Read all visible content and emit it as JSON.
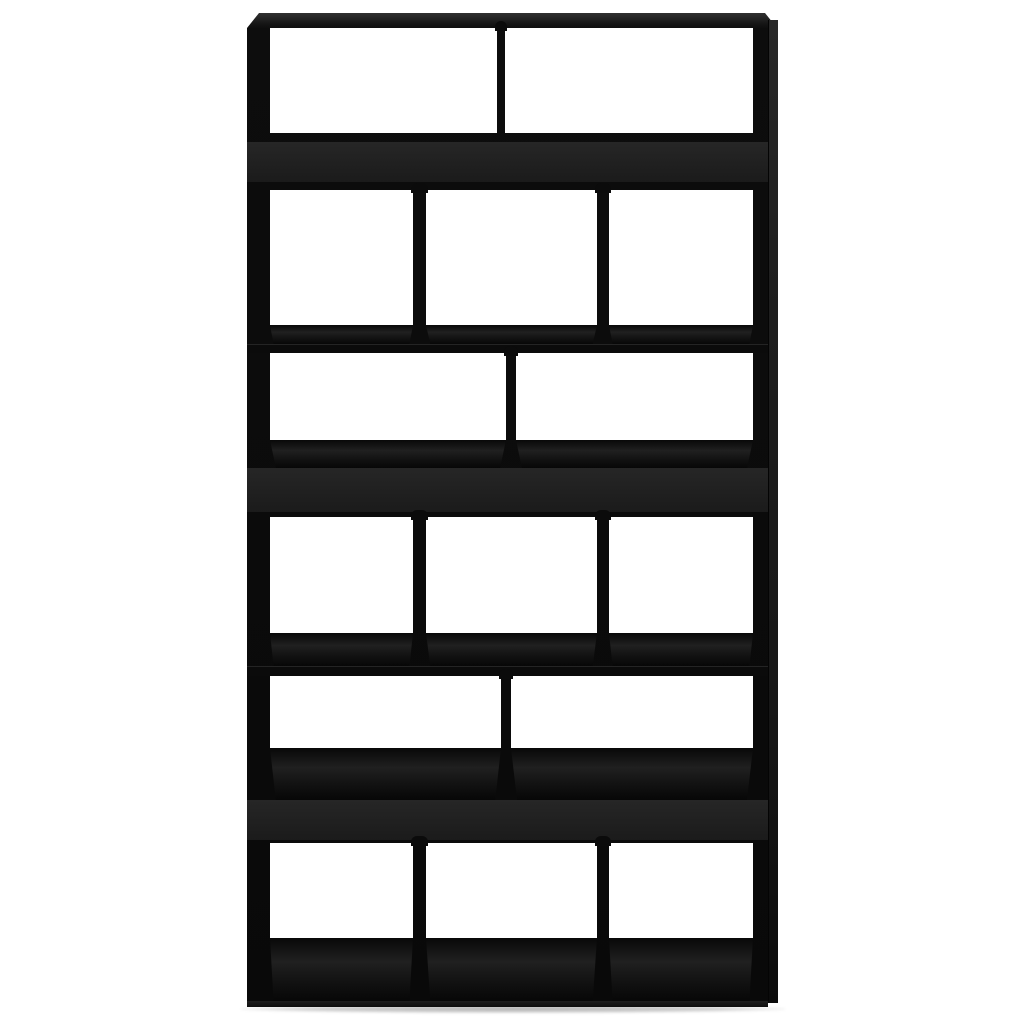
{
  "image": {
    "type": "product-photo",
    "subject": "Black wooden bookcase room divider with open compartments on a white background",
    "background_color": "#ffffff"
  },
  "colors": {
    "background": "#ffffff",
    "frame": "#0b0b0b",
    "frame_deep": "#060606",
    "band": "#262626",
    "band_dark": "#1b1b1b",
    "interior_floor": "#202020",
    "side_face": "#1e1e1e",
    "opening": "#ffffff",
    "shadow": "#c9c9c9"
  },
  "summary": {
    "open_rows": 6,
    "compartments_per_row": [
      2,
      3,
      2,
      3,
      2,
      3
    ],
    "total_compartments": 15,
    "closed_front_panels": 3
  },
  "unit": {
    "left": 247,
    "top": 13,
    "right": 777,
    "bottom": 1007,
    "front_right": 768,
    "inner_left": 270,
    "inner_right": 753,
    "top_board_bottom": 28
  },
  "rows": [
    {
      "name": "open-row-1",
      "kind": "open",
      "top": 28,
      "bottom": 133,
      "dividers": [
        [
          497,
          505
        ]
      ],
      "tabs": true
    },
    {
      "name": "front-panel-1",
      "kind": "band",
      "top": 133,
      "bottom": 190,
      "inner_top": 142,
      "inner_bottom": 182
    },
    {
      "name": "open-row-2",
      "kind": "open",
      "top": 190,
      "bottom": 325,
      "dividers": [
        [
          413,
          426
        ],
        [
          597,
          609
        ]
      ],
      "tabs": true
    },
    {
      "name": "shelf-ledge-1",
      "kind": "interior",
      "top": 325,
      "bottom": 353,
      "edge_top": 344
    },
    {
      "name": "open-row-3",
      "kind": "open",
      "top": 353,
      "bottom": 440,
      "dividers": [
        [
          506,
          516
        ]
      ],
      "tabs": true
    },
    {
      "name": "front-panel-2",
      "kind": "interior-band",
      "top": 440,
      "bottom": 517,
      "band_top": 468,
      "band_bottom": 512
    },
    {
      "name": "open-row-4",
      "kind": "open",
      "top": 517,
      "bottom": 633,
      "dividers": [
        [
          413,
          426
        ],
        [
          597,
          609
        ]
      ],
      "tabs": true
    },
    {
      "name": "shelf-ledge-2",
      "kind": "interior",
      "top": 633,
      "bottom": 676,
      "edge_top": 666
    },
    {
      "name": "open-row-5",
      "kind": "open",
      "top": 676,
      "bottom": 748,
      "dividers": [
        [
          501,
          511
        ]
      ],
      "tabs": true
    },
    {
      "name": "front-panel-3",
      "kind": "interior-band",
      "top": 748,
      "bottom": 843,
      "band_top": 800,
      "band_bottom": 840
    },
    {
      "name": "open-row-6",
      "kind": "open",
      "top": 843,
      "bottom": 938,
      "dividers": [
        [
          413,
          426
        ],
        [
          597,
          609
        ]
      ],
      "tabs": true
    },
    {
      "name": "bottom-interior",
      "kind": "floor",
      "top": 938,
      "bottom": 1001
    },
    {
      "name": "base-strip",
      "kind": "base",
      "top": 1001,
      "bottom": 1007
    }
  ]
}
